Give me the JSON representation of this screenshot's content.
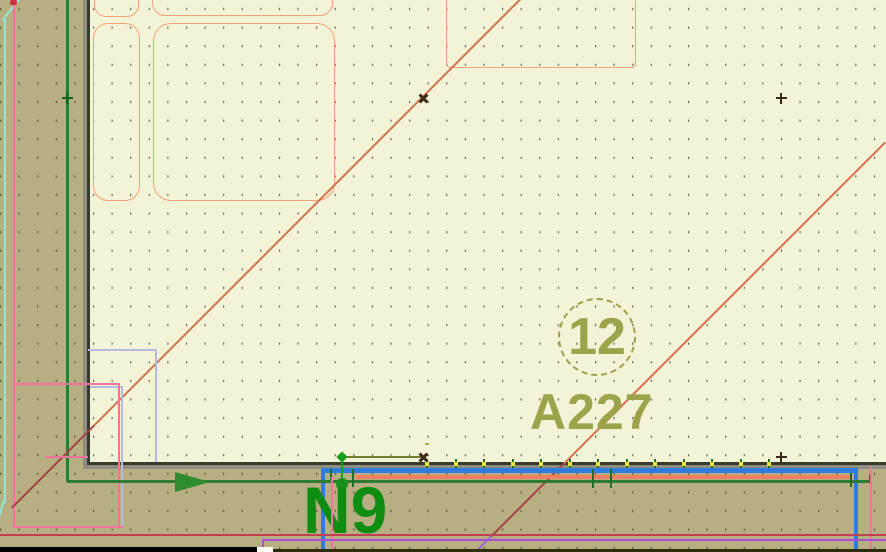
{
  "labels": {
    "zone_number": "12",
    "reference": "A227",
    "net_name": "N9"
  },
  "ruler": {
    "segments": 12
  },
  "colors": {
    "canvas_bg": "#f3f3d8",
    "band_bg": "#b7ae82",
    "grid_dot": "#44442e",
    "sheet_border_dark": "#39392c",
    "sheet_border_gray": "#8f8d7f",
    "silkscreen_orange": "#f2a276",
    "diagonal_salmon": "#d4714e",
    "diagonal_dark": "#a34444",
    "diagonal_violet": "#9a6ad0",
    "olive_text": "#9ba44b",
    "ruler_outline": "#a9b152",
    "net_green_dark": "#2e7c33",
    "net_green_bright": "#18a018",
    "net_label_green": "#0f8c12",
    "trace_blue": "#2f7ce0",
    "trace_salmon": "#f08060",
    "trace_crimson": "#bf4050",
    "trace_purple": "#ab4fd4",
    "keepout_pink": "#f3729f",
    "keepout_lightblue": "#b3bbde",
    "guide_cyan": "#8fe8d5",
    "pad_yellow": "#e8e53a",
    "marker_dark": "#3b2a16"
  }
}
